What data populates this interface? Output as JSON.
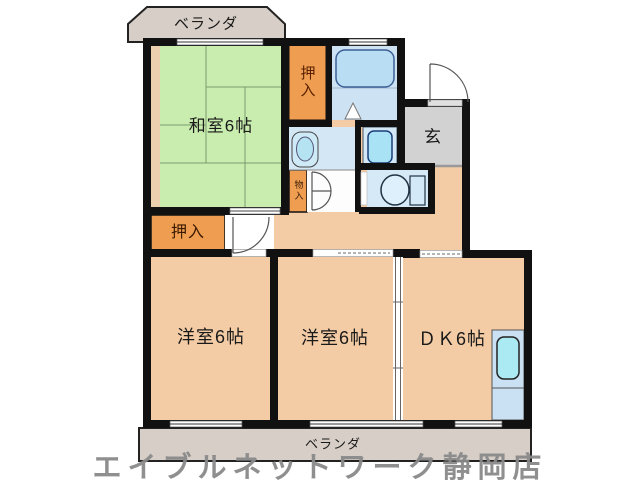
{
  "floorplan": {
    "labels": {
      "veranda_top": "ベランダ",
      "washitsu": "和室6帖",
      "oshiire_top": "押入",
      "genkan": "玄",
      "monoire": "物入",
      "oshiire_bottom": "押入",
      "yoshitsu_left": "洋室6帖",
      "yoshitsu_center": "洋室6帖",
      "dk": "ＤＫ6帖",
      "veranda_bottom": "ベランダ"
    },
    "watermark": "エイブルネットワーク静岡店",
    "rooms": [
      {
        "name": "和室",
        "size": "6帖"
      },
      {
        "name": "洋室",
        "size": "6帖"
      },
      {
        "name": "洋室",
        "size": "6帖"
      },
      {
        "name": "ＤＫ",
        "size": "6帖"
      }
    ],
    "colors": {
      "room_tan": "#f3cba4",
      "closet_orange": "#ef9d50",
      "tatami_green": "#c9edaf",
      "sanitary_blue": "#d4e7f5",
      "genkan_gray": "#d2d2d2",
      "veranda_beige": "#d7cfc7",
      "wall_black": "#111111",
      "watermark_gray": "#8a8a8a"
    }
  }
}
